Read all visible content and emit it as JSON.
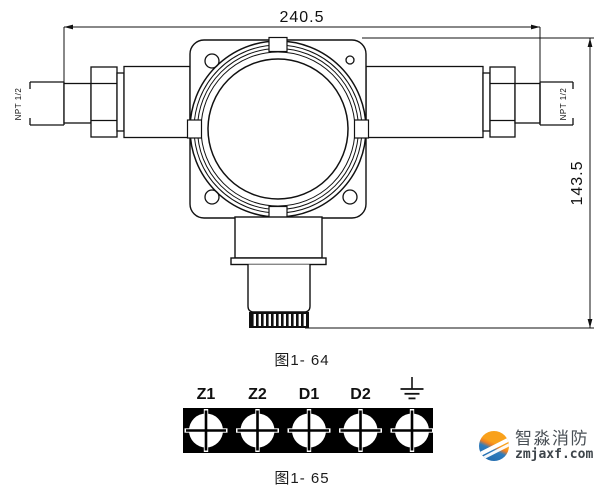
{
  "figure_detector": {
    "caption": "图1- 64",
    "dim_width": "240.5",
    "dim_height": "143.5",
    "thread_left": "NPT 1/2",
    "thread_right": "NPT 1/2"
  },
  "figure_terminals": {
    "caption": "图1- 65",
    "labels": [
      "Z1",
      "Z2",
      "D1",
      "D2"
    ],
    "ground_symbol": "earth-ground",
    "terminal_count": 5
  },
  "watermark": {
    "brand": "智淼消防",
    "domain": "zmjaxf.com",
    "color_orange": "#f9a11b",
    "color_blue": "#2e7cbd"
  },
  "colors": {
    "line": "#111111",
    "background": "#ffffff",
    "terminal_block": "#000000"
  }
}
